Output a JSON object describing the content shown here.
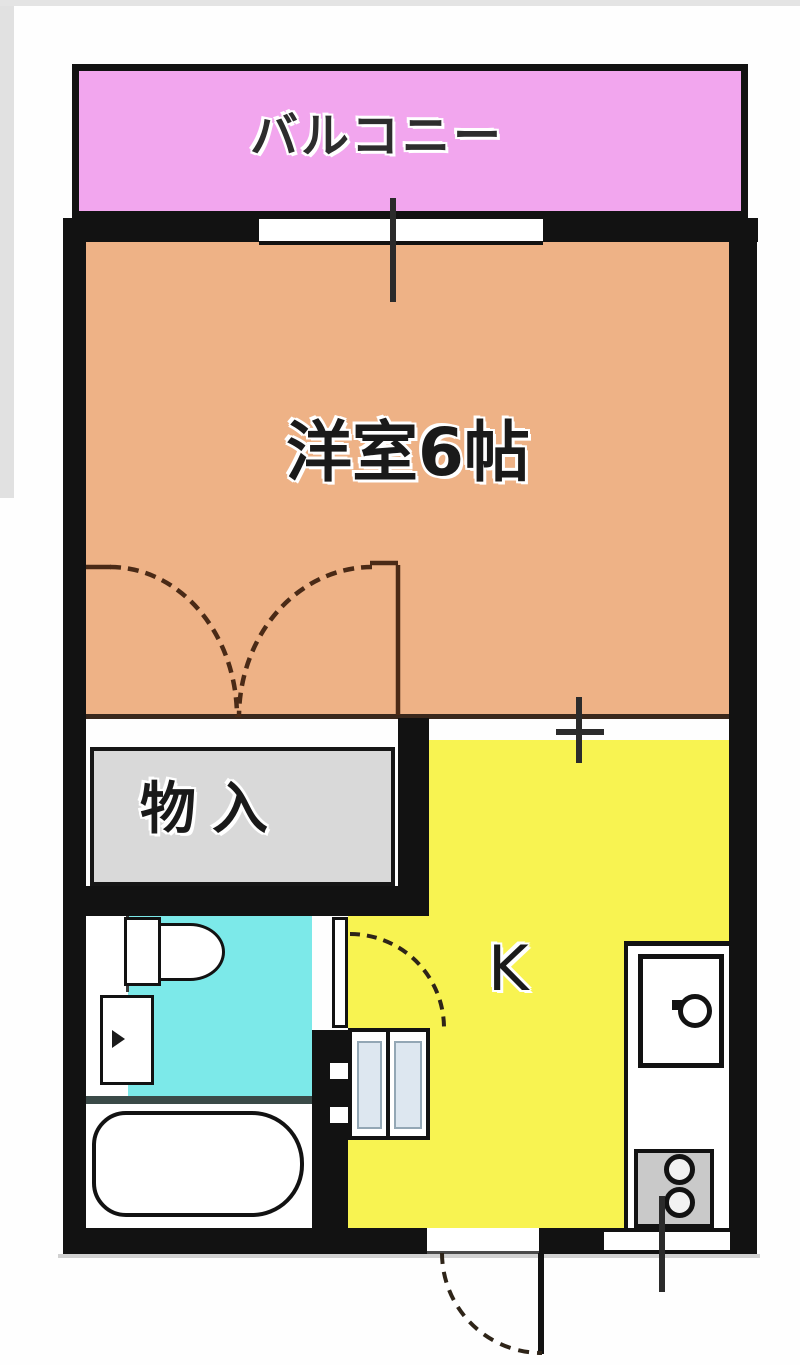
{
  "labels": {
    "balcony": "バルコニー",
    "western_room": "洋室6帖",
    "closet": "物入",
    "kitchen": "K"
  },
  "colors": {
    "wall": "#121212",
    "balcony_fill": "#f2a6ee",
    "room_fill": "#eeb286",
    "kitchen_fill": "#f8f351",
    "toilet_fill": "#7ce9e9",
    "closet_fill": "#d9d9d9",
    "stove_fill": "#c9c9c9",
    "fixture_white": "#ffffff",
    "fixture_panel": "#dde7f0",
    "closet_door_arc": "#4a2a16",
    "door_arc": "#2e2418",
    "divider_line": "#3a281c",
    "bath_divider": "#3a4a48",
    "tick": "#2b2b2b",
    "photo_edge": "#d9d9d9"
  }
}
